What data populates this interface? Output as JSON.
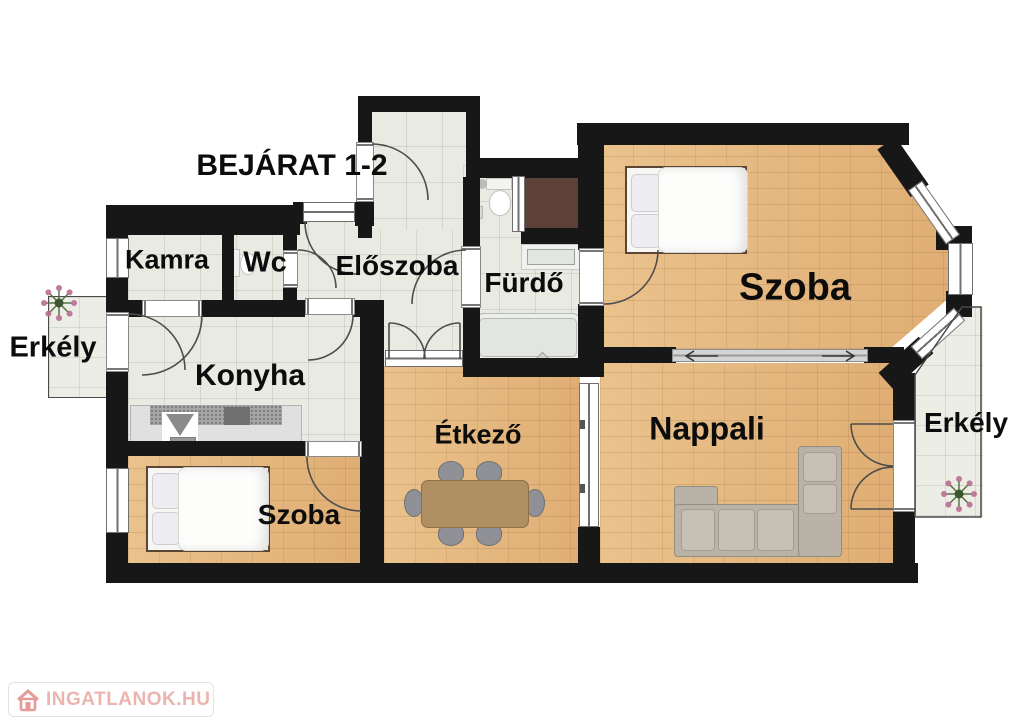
{
  "labels": {
    "entrance": "BEJÁRAT 1-2",
    "pantry": "Kamra",
    "wc": "Wc",
    "hall": "Előszoba",
    "bathroom": "Fürdő",
    "bedroom_large": "Szoba",
    "balcony_left": "Erkély",
    "kitchen": "Konyha",
    "bedroom_small": "Szoba",
    "dining": "Étkező",
    "living": "Nappali",
    "balcony_right": "Erkély"
  },
  "watermark": {
    "text": "INGATLANOK.HU"
  },
  "colors": {
    "wall": "#171717",
    "wood_floor": "#e4b67e",
    "tile_floor": "#e9eae1",
    "balcony_floor": "#ecede5",
    "shower_brown": "#5d4139",
    "watermark_pink": "#ecb4ae",
    "sofa_gray": "#b9b2a7",
    "table_tan": "#b08f63"
  },
  "symbols": [
    "double-bed-icon",
    "single-bed-icon",
    "corner-sofa-icon",
    "dining-table-icon",
    "toilet-icon",
    "wc-toilet-icon",
    "bathtub-icon",
    "washbasin-icon",
    "kitchen-counter-icon",
    "plant-icon",
    "door-swing-arc",
    "sliding-door-arrows"
  ]
}
